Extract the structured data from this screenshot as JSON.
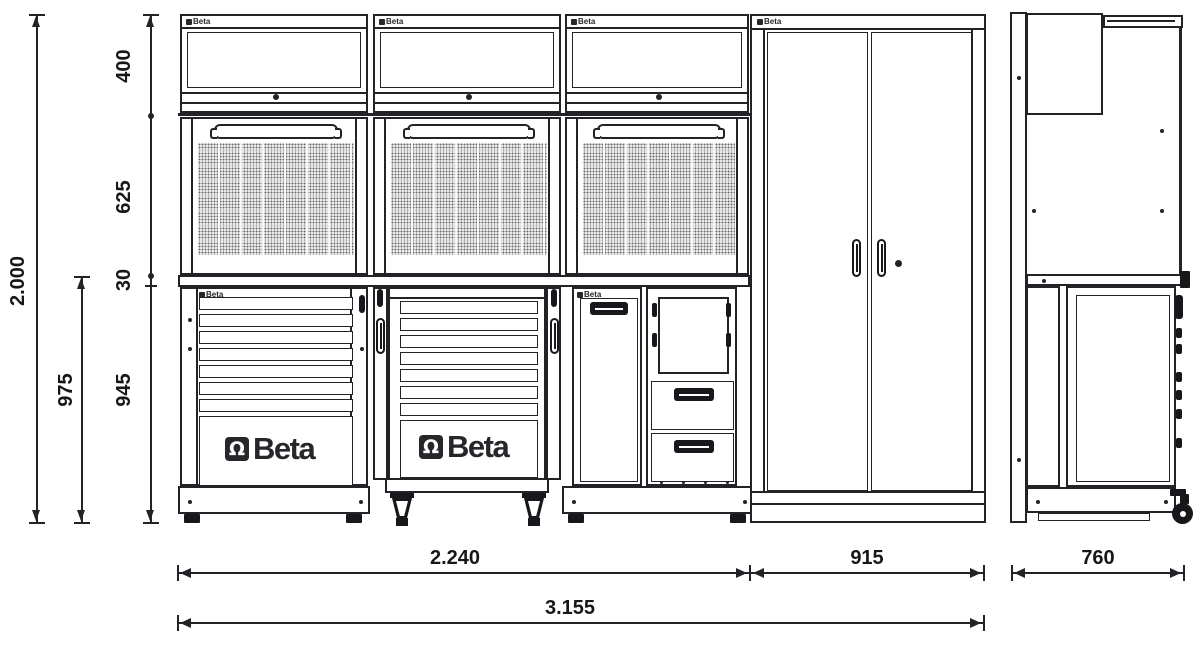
{
  "brand": {
    "name": "Beta",
    "mark_glyph": "Ω"
  },
  "dimensions": {
    "total_height": "2.000",
    "wall_unit_height": "400",
    "panel_height": "625",
    "worktop_thickness": "30",
    "base_unit_height": "945",
    "base_with_worktop_height": "975",
    "modular_section_width": "2.240",
    "tall_cabinet_width": "915",
    "total_width": "3.155",
    "depth": "760"
  }
}
